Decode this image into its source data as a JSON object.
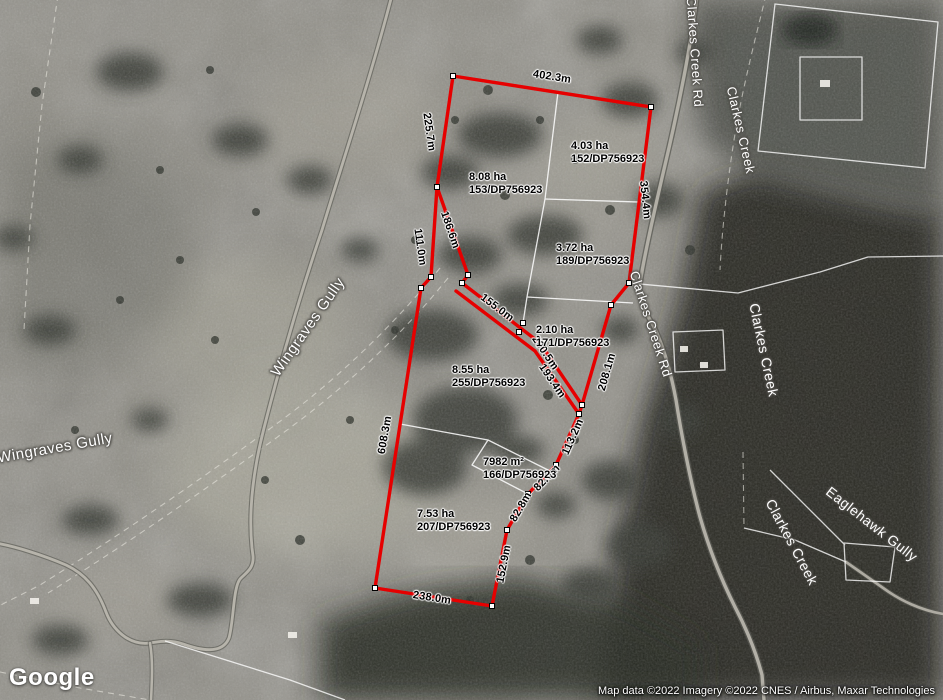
{
  "branding": {
    "logo": "Google"
  },
  "attribution": {
    "text": "Map data ©2022 Imagery ©2022 CNES / Airbus, Maxar Technologies"
  },
  "overlay": {
    "boundary_color": "#e60000",
    "cadastral_color": "#ffffff",
    "measurements": [
      {
        "text": "402.3m"
      },
      {
        "text": "225.7m"
      },
      {
        "text": "354.4m"
      },
      {
        "text": "186.6m"
      },
      {
        "text": "111.0m"
      },
      {
        "text": "155.0m"
      },
      {
        "text": "200.5m"
      },
      {
        "text": "193.4m"
      },
      {
        "text": "208.1m"
      },
      {
        "text": "608.3m"
      },
      {
        "text": "113.2m"
      },
      {
        "text": "82.0m"
      },
      {
        "text": "82.8m"
      },
      {
        "text": "152.9m"
      },
      {
        "text": "238.0m"
      }
    ],
    "parcels": [
      {
        "area": "4.03 ha",
        "lot": "152/DP756923"
      },
      {
        "area": "8.08 ha",
        "lot": "153/DP756923"
      },
      {
        "area": "3.72 ha",
        "lot": "189/DP756923"
      },
      {
        "area": "2.10 ha",
        "lot": "171/DP756923"
      },
      {
        "area": "8.55 ha",
        "lot": "255/DP756923"
      },
      {
        "area": "7982 m²",
        "lot": "166/DP756923"
      },
      {
        "area": "7.53 ha",
        "lot": "207/DP756923"
      }
    ]
  },
  "place_labels": [
    {
      "text": "Wingraves Gully"
    },
    {
      "text": "Wingraves Gully"
    },
    {
      "text": "Clarkes Creek Rd"
    },
    {
      "text": "Clarkes Creek Rd"
    },
    {
      "text": "Clarkes Creek"
    },
    {
      "text": "Clarkes Creek"
    },
    {
      "text": "Clarkes Creek"
    },
    {
      "text": "Eaglehawk Gully"
    }
  ]
}
